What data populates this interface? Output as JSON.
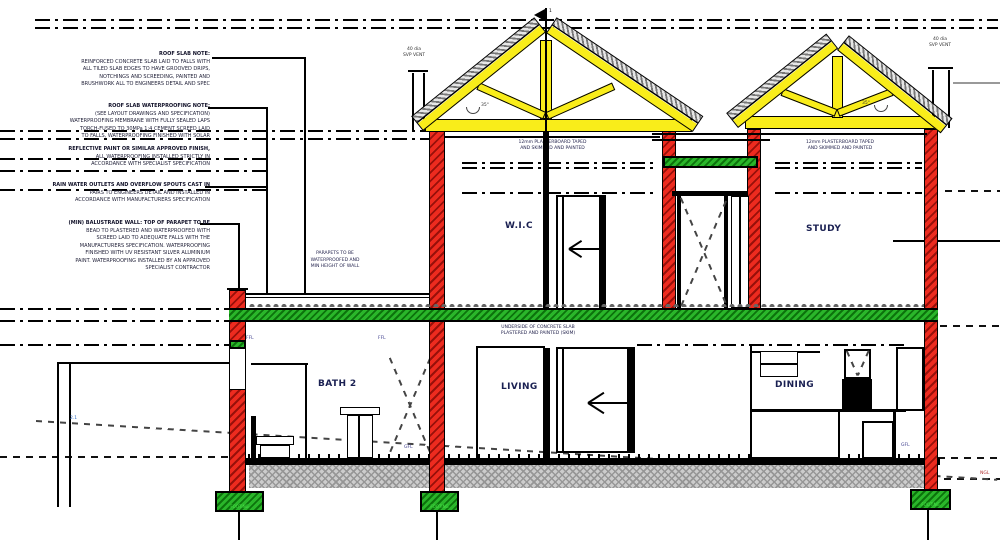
{
  "colors": {
    "wall_red": "#ed2b1f",
    "truss_yellow": "#f9ed1a",
    "slab_green": "#2ab62a",
    "ground_gray": "#cccccc"
  },
  "notes_left": {
    "roof_slab": {
      "lines": [
        "ROOF SLAB NOTE:",
        "REINFORCED CONCRETE SLAB LAID TO FALLS WITH",
        "ALL TILED SLAB EDGES TO HAVE GROOVED DRIPS,",
        "NOTCHINGS AND SCREEDING, PAINTED AND",
        "BRUSHWORK ALL TO ENGINEERS DETAIL AND SPEC"
      ]
    },
    "waterproofing": {
      "lines": [
        "ROOF SLAB WATERPROOFING NOTE:",
        "(SEE LAYOUT DRAWINGS AND SPECIFICATION)",
        "WATERPROOFING MEMBRANE WITH FULLY SEALED LAPS",
        "TORCH-FUSED TO 30MPa 1:4 CEMENT SCREED LAID",
        "TO FALLS, WATERPROOFING FINISHED WITH SOLAR"
      ]
    },
    "membrane": {
      "lines": [
        "REFLECTIVE PAINT OR SIMILAR APPROVED FINISH,",
        "ALL WATERPROOFING INSTALLED STRICTLY IN",
        "ACCORDANCE WITH SPECIALIST SPECIFICATION"
      ]
    },
    "outlets": {
      "lines": [
        "RAIN WATER OUTLETS AND OVERFLOW SPOUTS CAST IN",
        "PAIRS TO ENGINEERS DETAIL AND INSTALLED IN",
        "ACCORDANCE WITH MANUFACTURERS SPECIFICATION"
      ]
    },
    "parapet_wall": {
      "lines": [
        "(MIN) BALUSTRADE WALL: TOP OF PARAPET TO BE",
        "BEAD TO PLASTERED AND WATERPROOFED WITH",
        "SCREED LAID TO ADEQUATE FALLS WITH THE",
        "MANUFACTURERS SPECIFICATION. WATERPROOFING",
        "FINISHED WITH UV RESISTANT SILVER ALUMINIUM",
        "PAINT. WATERPROOFING INSTALLED BY AN APPROVED",
        "SPECIALIST CONTRACTOR"
      ]
    }
  },
  "inline_notes": {
    "parapet_mid": {
      "lines": [
        "PARAPETS TO BE",
        "WATERPROOFED AND",
        "MIN HEIGHT OF WALL"
      ]
    },
    "plasterboard_left": {
      "lines": [
        "12mm PLASTERBOARD TAPED",
        "AND SKIMMED AND PAINTED"
      ]
    },
    "plasterboard_right": {
      "lines": [
        "12mm PLASTERBOARD TAPED",
        "AND SKIMMED AND PAINTED"
      ]
    },
    "slab_underside": {
      "lines": [
        "UNDERSIDE OF CONCRETE SLAB",
        "PLASTERED AND PAINTED (SKIM)"
      ]
    },
    "vent_left": {
      "lines": [
        "40 dia",
        "SVP VENT"
      ]
    },
    "vent_right": {
      "lines": [
        "40 dia",
        "SVP VENT"
      ]
    }
  },
  "rooms": {
    "wic": "W.I.C",
    "study": "STUDY",
    "bath": "BATH 2",
    "living": "LIVING",
    "dining": "DINING"
  },
  "labels": {
    "ffl": "FFL",
    "gfl": "GFL",
    "ngl": "NGL",
    "level_marker": "2.1",
    "pitch_left": "35°",
    "pitch_right": "35°",
    "section_flag": "1",
    "footing": "FOOTING"
  }
}
